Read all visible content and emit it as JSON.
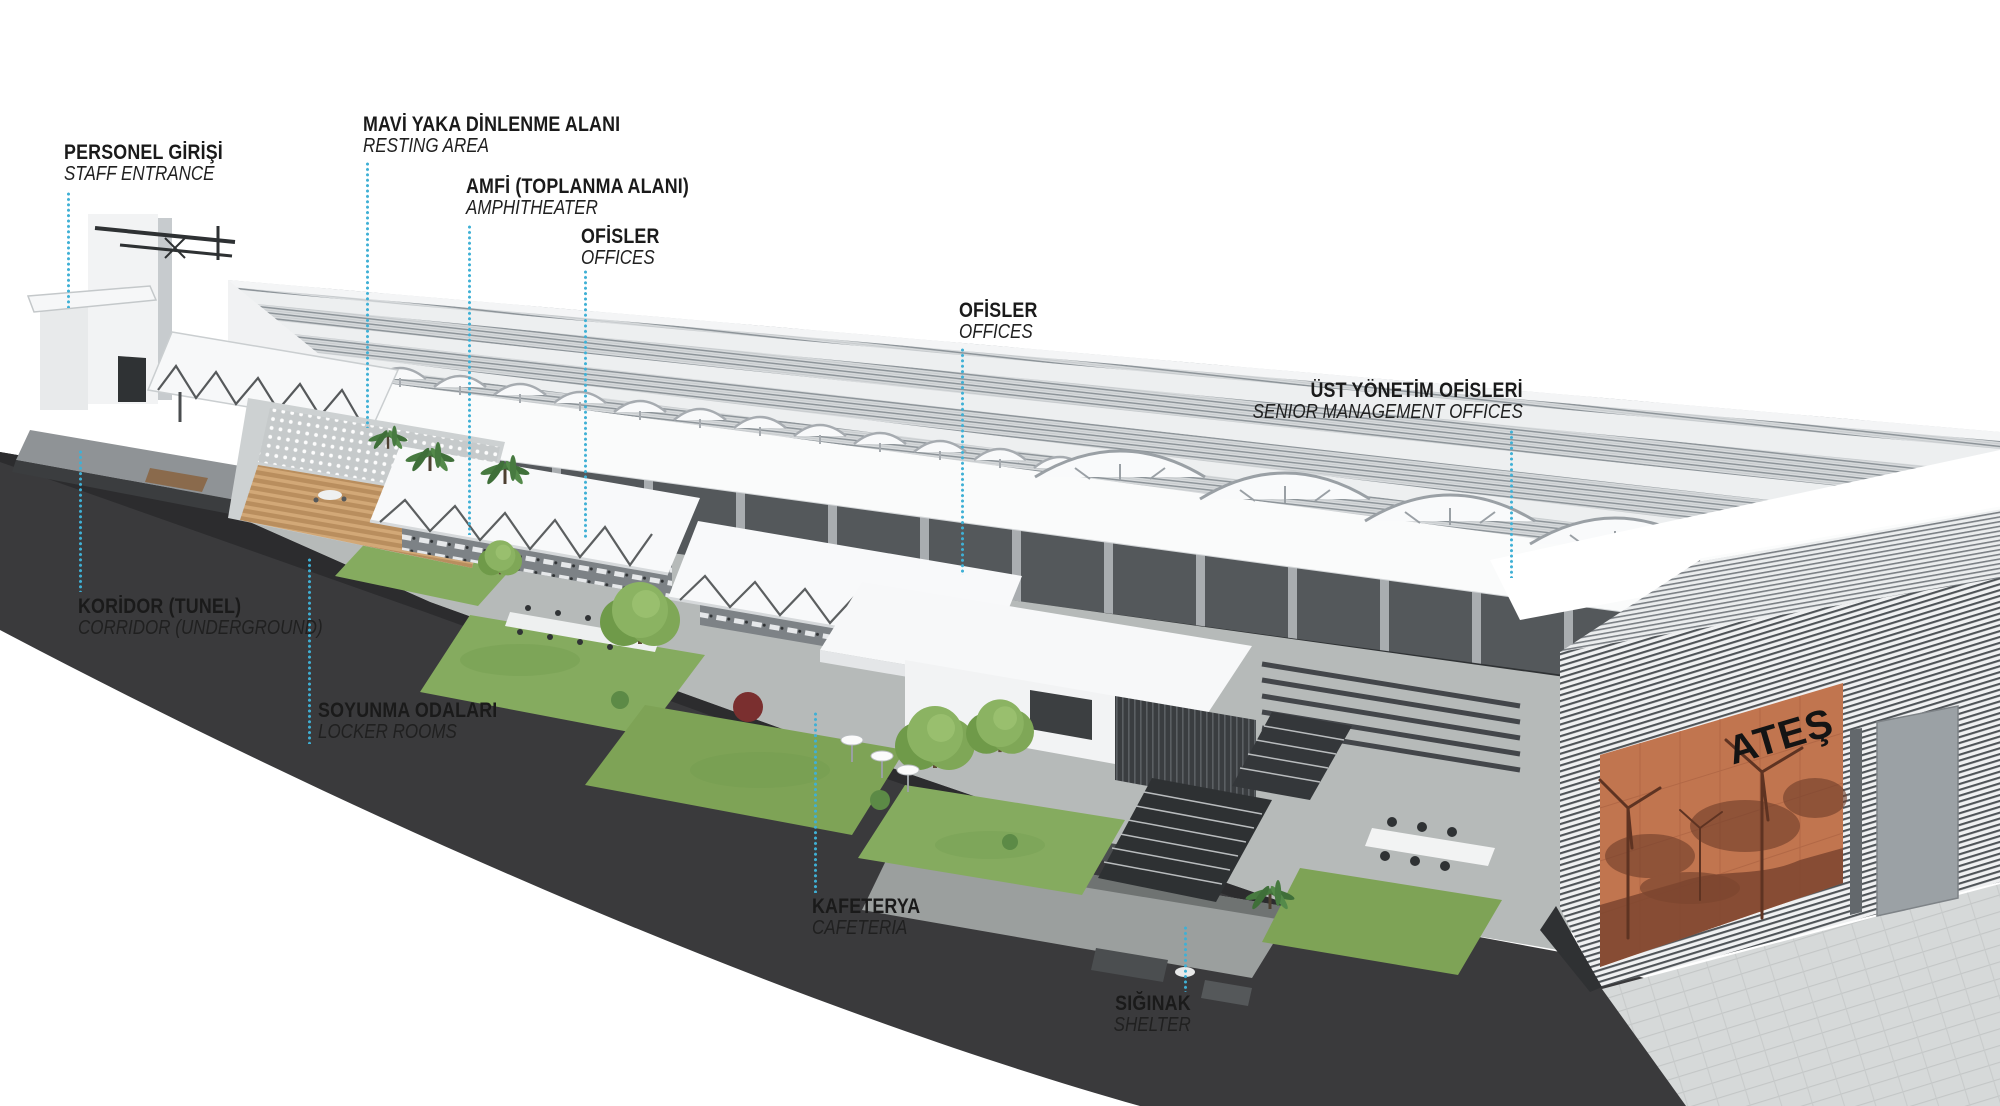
{
  "scene": {
    "logo_text": "ATEŞ",
    "colors": {
      "leader_line": "#3fb0d5",
      "label_text": "#1a1a1a",
      "mural_orange": "#c1754f",
      "mural_artwork": "#7d452f",
      "base_dark": "#3a3a3c",
      "grass": "#85ab5f",
      "roof_light": "#e9ebec",
      "wall_white": "#f8f9fa"
    }
  },
  "labels": [
    {
      "id": "staff-entrance",
      "tr": "PERSONEL GİRİŞİ",
      "en": "STAFF ENTRANCE"
    },
    {
      "id": "resting-area",
      "tr": "MAVİ YAKA DİNLENME ALANI",
      "en": "RESTING AREA"
    },
    {
      "id": "amphitheater",
      "tr": "AMFİ (TOPLANMA ALANI)",
      "en": "AMPHITHEATER"
    },
    {
      "id": "offices-1",
      "tr": "OFİSLER",
      "en": "OFFICES"
    },
    {
      "id": "offices-2",
      "tr": "OFİSLER",
      "en": "OFFICES"
    },
    {
      "id": "senior-management",
      "tr": "ÜST YÖNETİM OFİSLERİ",
      "en": "SENIOR MANAGEMENT OFFICES"
    },
    {
      "id": "corridor",
      "tr": "KORİDOR (TUNEL)",
      "en": "CORRIDOR (UNDERGROUND)"
    },
    {
      "id": "locker-rooms",
      "tr": "SOYUNMA ODALARI",
      "en": "LOCKER ROOMS"
    },
    {
      "id": "cafeteria",
      "tr": "KAFETERYA",
      "en": "CAFETERIA"
    },
    {
      "id": "shelter",
      "tr": "SIĞINAK",
      "en": "SHELTER"
    }
  ]
}
